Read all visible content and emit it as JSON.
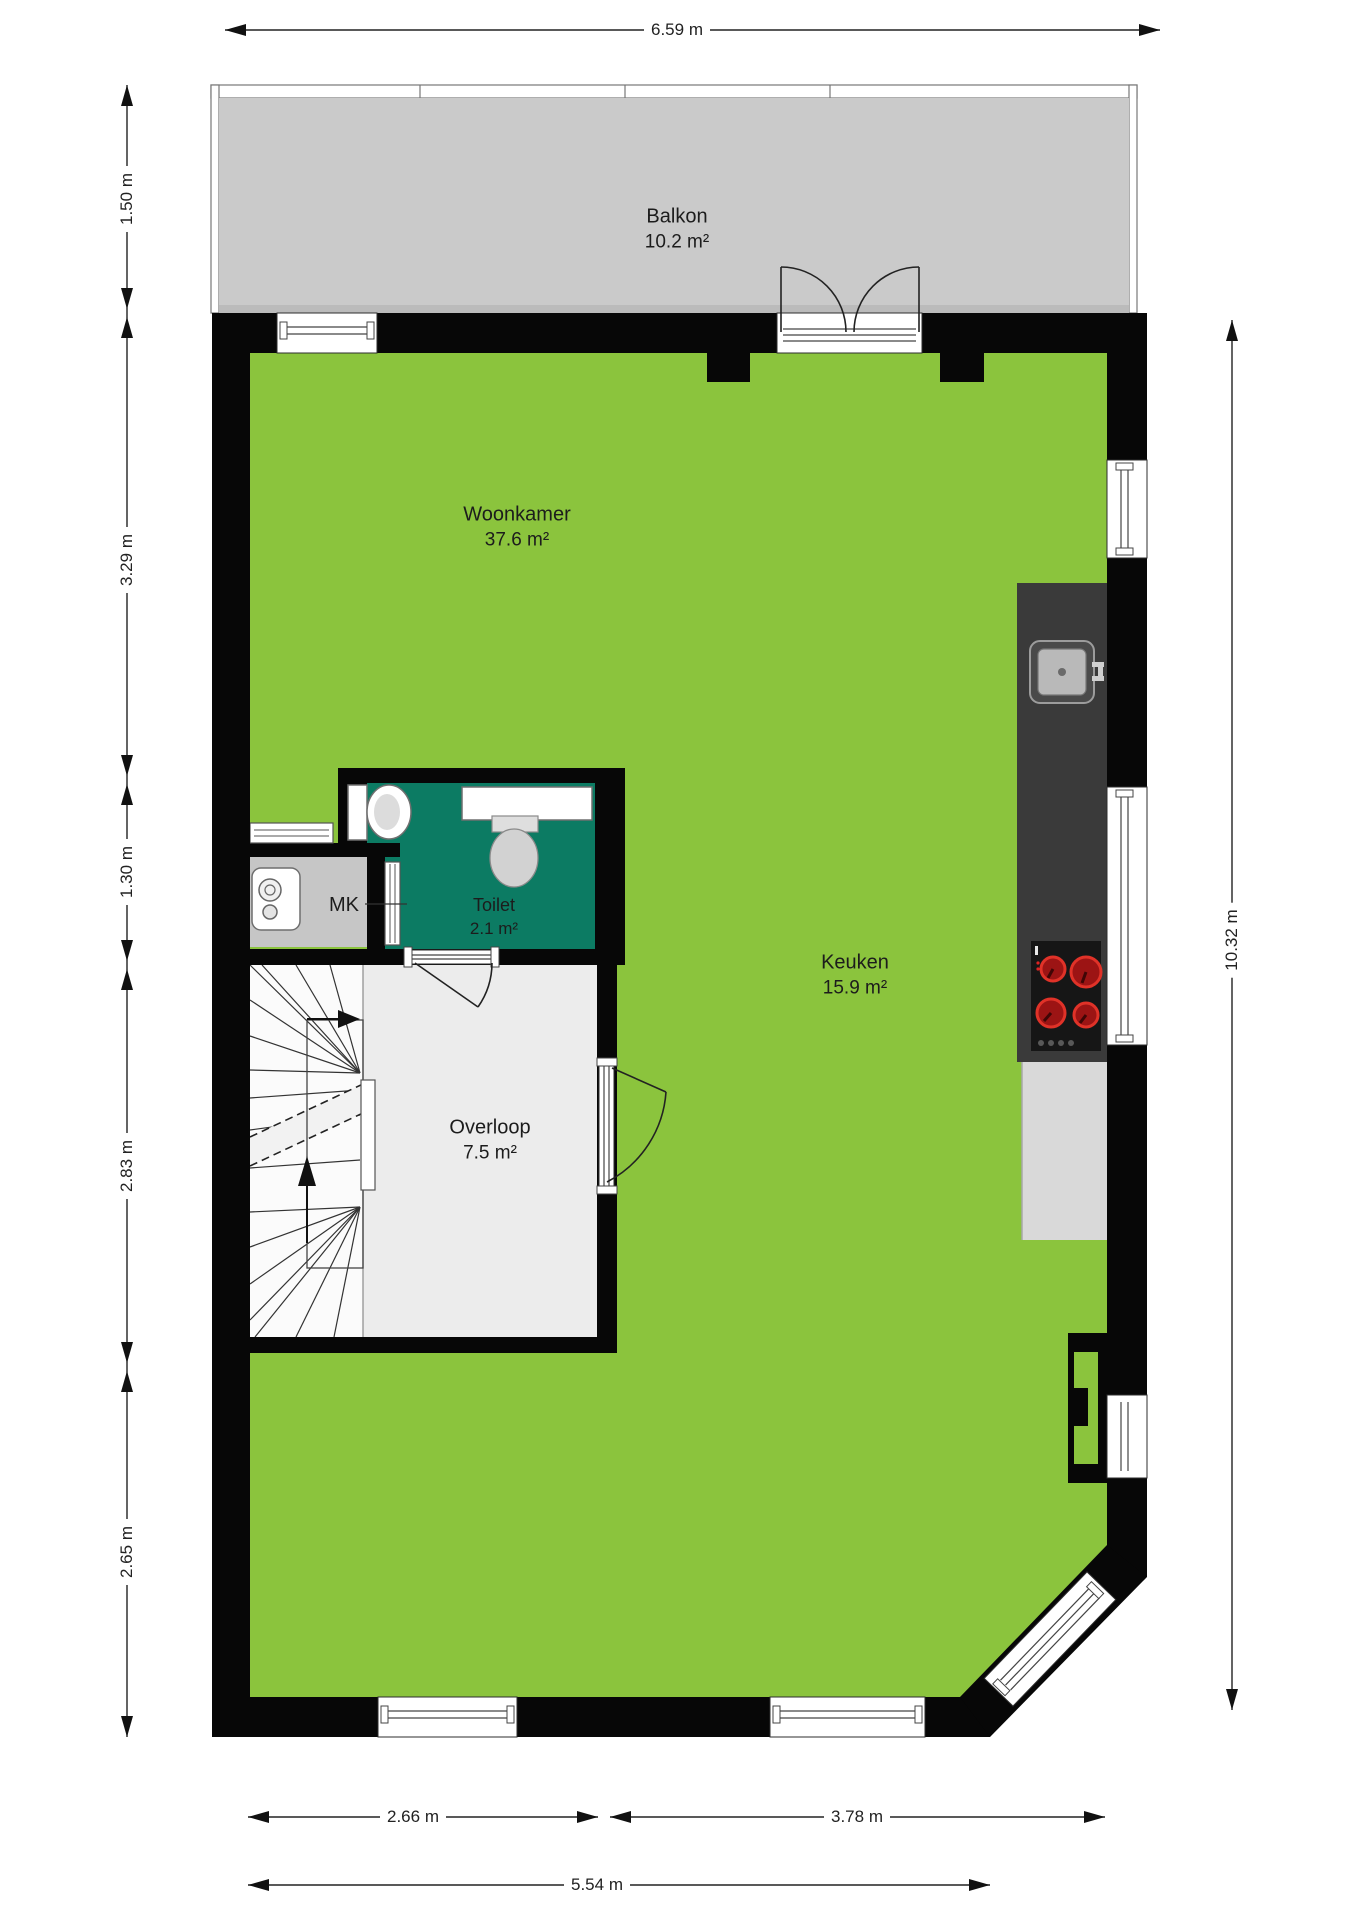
{
  "title": "Floor plan",
  "rooms": {
    "balkon": {
      "name": "Balkon",
      "area": "10.2 m²"
    },
    "woonkamer": {
      "name": "Woonkamer",
      "area": "37.6 m²"
    },
    "toilet": {
      "name": "Toilet",
      "area": "2.1 m²"
    },
    "mk": {
      "name": "MK"
    },
    "keuken": {
      "name": "Keuken",
      "area": "15.9 m²"
    },
    "overloop": {
      "name": "Overloop",
      "area": "7.5 m²"
    }
  },
  "dimensions": {
    "top": "6.59 m",
    "left": [
      "1.50 m",
      "3.29 m",
      "1.30 m",
      "2.83 m",
      "2.65 m"
    ],
    "right": "10.32 m",
    "bottom_segments": [
      "2.66 m",
      "3.78 m"
    ],
    "bottom_total": "5.54 m"
  },
  "icons": {
    "boiler": "boiler-icon",
    "wc": "wc-icon",
    "washbasin": "washbasin-icon",
    "kitchen_sink": "kitchen-sink-icon",
    "cooktop": "cooktop-icon",
    "stairs": "stairs-icon"
  },
  "colors": {
    "wall": "#070707",
    "floor-green": "#8bc43d",
    "balcony-gray": "#cacaca",
    "toilet-teal": "#0c7b63",
    "overloop-gray": "#ececec",
    "mk-gray": "#c6c6c6",
    "counter-dark": "#3a3a3a",
    "cabinet-gray": "#d9d9d9",
    "burner-ring": "#e03228"
  }
}
